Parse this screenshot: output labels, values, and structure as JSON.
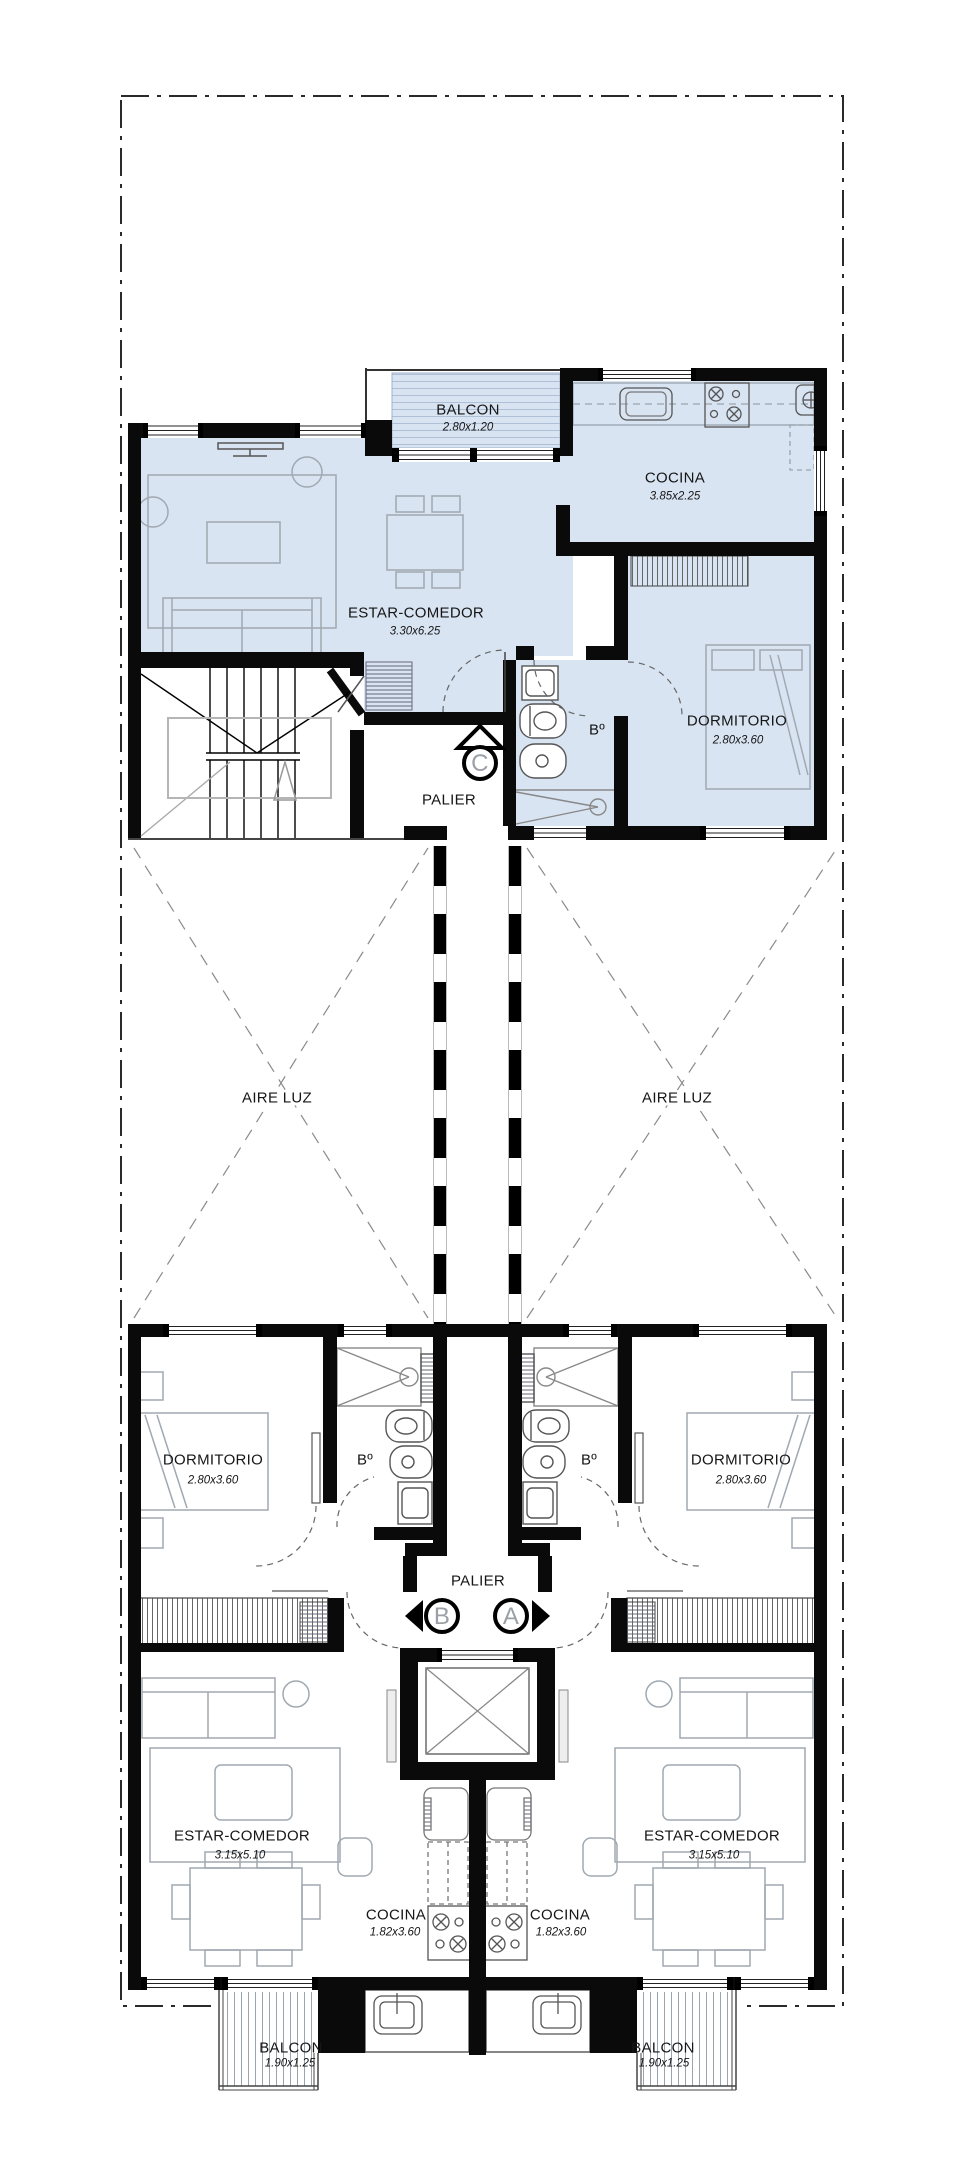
{
  "plan": {
    "upper_unit": {
      "marker": "C",
      "balcon": {
        "name": "BALCON",
        "dim": "2.80x1.20"
      },
      "cocina": {
        "name": "COCINA",
        "dim": "3.85x2.25"
      },
      "estar_comedor": {
        "name": "ESTAR-COMEDOR",
        "dim": "3.30x6.25"
      },
      "dormitorio": {
        "name": "DORMITORIO",
        "dim": "2.80x3.60"
      },
      "bano": {
        "name": "Bº"
      },
      "palier": {
        "name": "PALIER"
      }
    },
    "aire_luz_left": {
      "name": "AIRE LUZ"
    },
    "aire_luz_right": {
      "name": "AIRE LUZ"
    },
    "lower_palier": {
      "name": "PALIER"
    },
    "unit_b": {
      "marker": "B",
      "dormitorio": {
        "name": "DORMITORIO",
        "dim": "2.80x3.60"
      },
      "bano": {
        "name": "Bº"
      },
      "estar_comedor": {
        "name": "ESTAR-COMEDOR",
        "dim": "3.15x5.10"
      },
      "cocina": {
        "name": "COCINA",
        "dim": "1.82x3.60"
      },
      "balcon": {
        "name": "BALCON",
        "dim": "1.90x1.25"
      }
    },
    "unit_a": {
      "marker": "A",
      "dormitorio": {
        "name": "DORMITORIO",
        "dim": "2.80x3.60"
      },
      "bano": {
        "name": "Bº"
      },
      "estar_comedor": {
        "name": "ESTAR-COMEDOR",
        "dim": "3.15x5.10"
      },
      "cocina": {
        "name": "COCINA",
        "dim": "1.82x3.60"
      },
      "balcon": {
        "name": "BALCON",
        "dim": "1.90x1.25"
      }
    }
  },
  "colors": {
    "unit_highlight": "#d9e4f3",
    "wall": "#0a0a0a",
    "furniture_line": "#a0a8b0",
    "balcony_hatch": "#aebfd6"
  }
}
